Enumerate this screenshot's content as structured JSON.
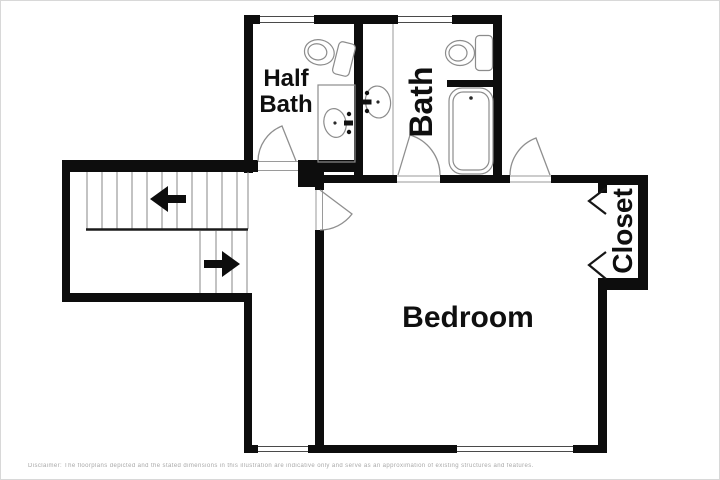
{
  "floorplan": {
    "rooms": {
      "half_bath": {
        "label_lines": [
          "Half",
          "Bath"
        ]
      },
      "bath": {
        "label": "Bath"
      },
      "bedroom": {
        "label": "Bedroom"
      },
      "closet": {
        "label": "Closet"
      }
    },
    "stairs": {
      "up_arrow_direction": "left",
      "down_arrow_direction": "right"
    },
    "fixtures": {
      "half_bath": [
        "toilet",
        "vanity-sink"
      ],
      "bath": [
        "toilet",
        "sink",
        "bathtub"
      ],
      "closet": [
        "bifold-doors"
      ]
    },
    "windows_count": 4,
    "doors_count": 4,
    "colors": {
      "wall": "#0d0d0d",
      "background": "#ffffff",
      "fixture_line": "#8c8c8c",
      "label_text": "#0f0f0f",
      "disclaimer_text": "#a8a8a8"
    },
    "disclaimer": "Disclaimer: The floorplans depicted and the stated dimensions in this illustration are indicative only and serve as an approximation of existing structures and features."
  }
}
